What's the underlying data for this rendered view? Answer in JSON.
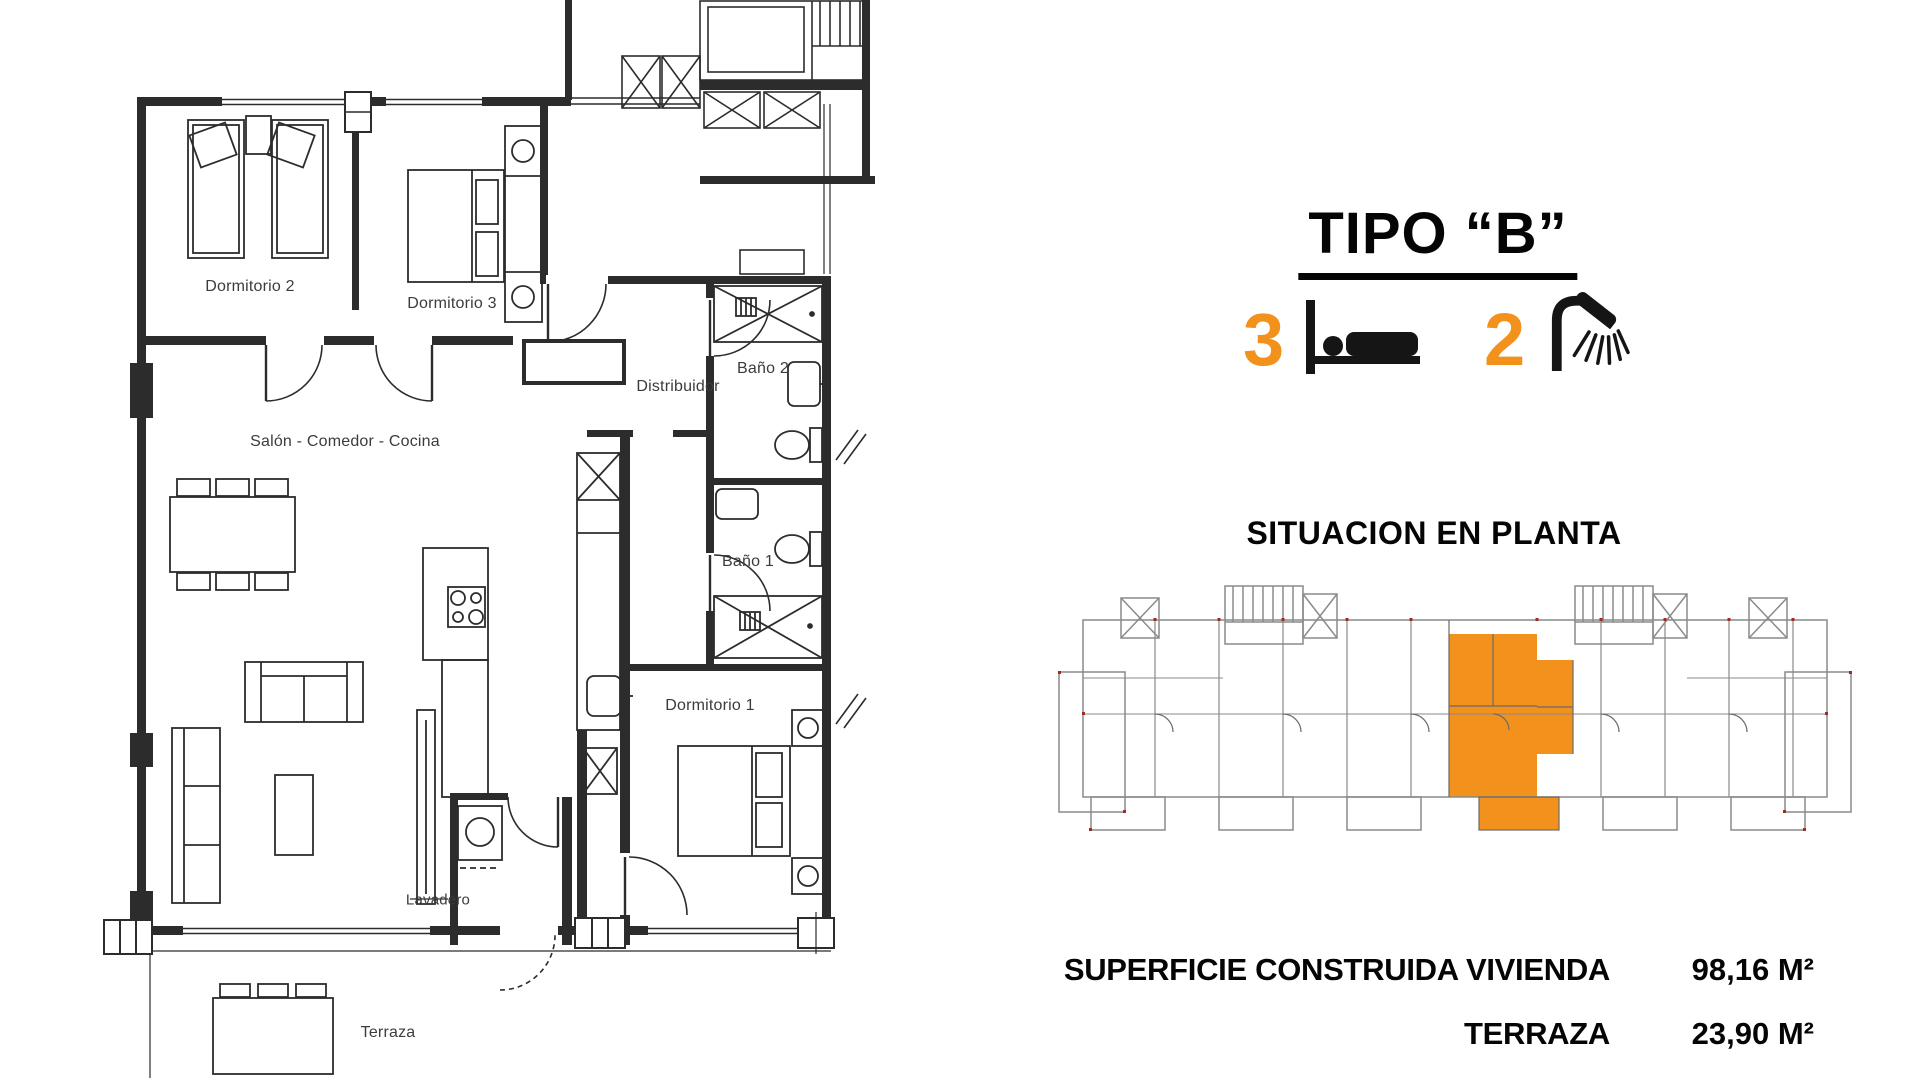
{
  "panel": {
    "title": "TIPO “B”",
    "bedrooms_count": "3",
    "bathrooms_count": "2",
    "situation_heading": "SITUACION EN PLANTA",
    "areas": [
      {
        "label": "SUPERFICIE CONSTRUIDA VIVIENDA",
        "value": "98,16 M²"
      },
      {
        "label": "TERRAZA",
        "value": "23,90 M²"
      }
    ],
    "accent_color": "#F2911B",
    "icons": [
      "bed-icon",
      "shower-icon"
    ]
  },
  "floor_plan": {
    "line_color": "#2c2c2c",
    "rooms": [
      {
        "label": "Dormitorio 2"
      },
      {
        "label": "Dormitorio 3"
      },
      {
        "label": "Distribuidor"
      },
      {
        "label": "Baño 2"
      },
      {
        "label": "Salón - Comedor - Cocina"
      },
      {
        "label": "Baño 1"
      },
      {
        "label": "Dormitorio 1"
      },
      {
        "label": "Lavadero"
      },
      {
        "label": "Terraza"
      }
    ]
  }
}
